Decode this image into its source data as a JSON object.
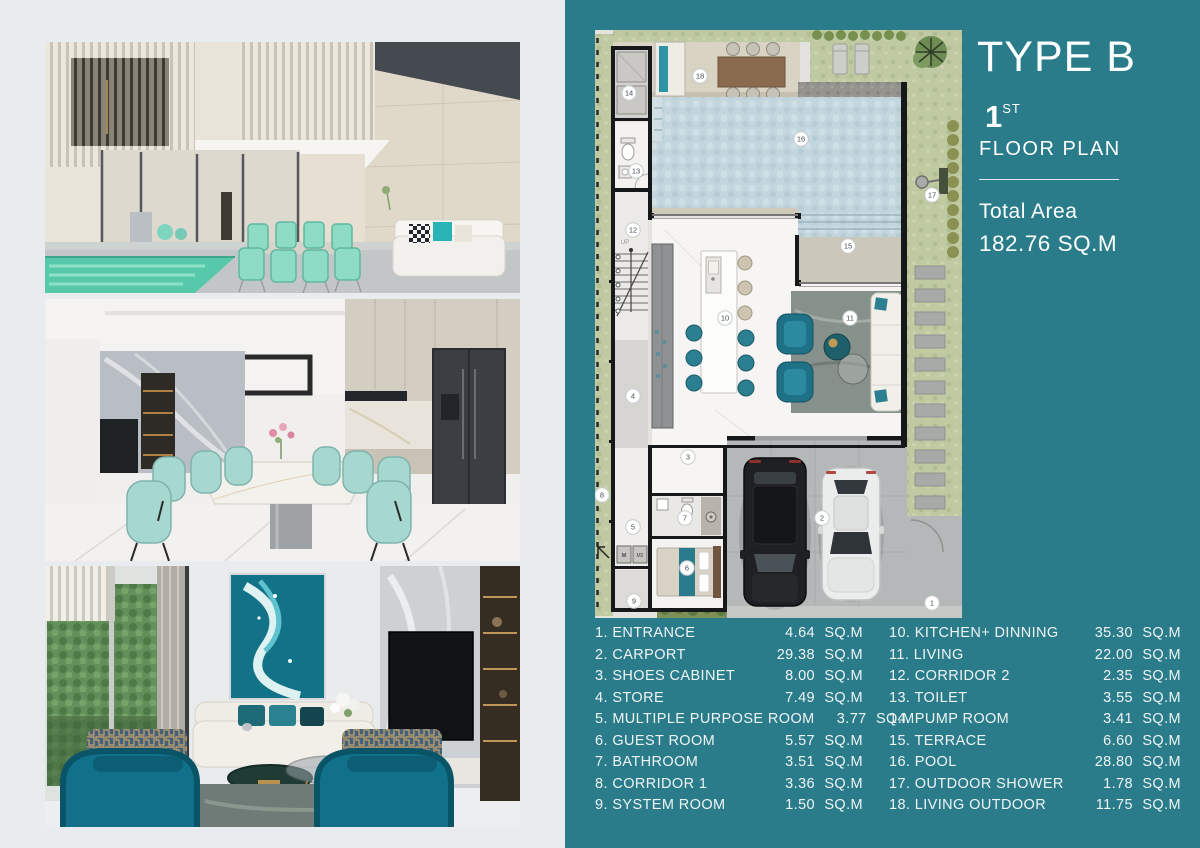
{
  "header": {
    "title": "TYPE B",
    "floor_number": "1",
    "floor_ordinal": "ST",
    "floor_label": "FLOOR PLAN",
    "total_area_label": "Total Area",
    "total_area_value": "182.76 SQ.M"
  },
  "legend": {
    "unit": "SQ.M",
    "left": [
      {
        "id": "1",
        "name": "ENTRANCE",
        "area": "4.64"
      },
      {
        "id": "2",
        "name": "CARPORT",
        "area": "29.38"
      },
      {
        "id": "3",
        "name": "SHOES CABINET",
        "area": "8.00"
      },
      {
        "id": "4",
        "name": "STORE",
        "area": "7.49"
      },
      {
        "id": "5",
        "name": "MULTIPLE PURPOSE ROOM",
        "area": "3.77"
      },
      {
        "id": "6",
        "name": "GUEST ROOM",
        "area": "5.57"
      },
      {
        "id": "7",
        "name": "BATHROOM",
        "area": "3.51"
      },
      {
        "id": "8",
        "name": "CORRIDOR 1",
        "area": "3.36"
      },
      {
        "id": "9",
        "name": "SYSTEM ROOM",
        "area": "1.50"
      }
    ],
    "right": [
      {
        "id": "10",
        "name": "KITCHEN+ DINNING",
        "area": "35.30"
      },
      {
        "id": "11",
        "name": "LIVING",
        "area": "22.00"
      },
      {
        "id": "12",
        "name": "CORRIDOR 2",
        "area": "2.35"
      },
      {
        "id": "13",
        "name": "TOILET",
        "area": "3.55"
      },
      {
        "id": "14",
        "name": "PUMP ROOM",
        "area": "3.41"
      },
      {
        "id": "15",
        "name": "TERRACE",
        "area": "6.60"
      },
      {
        "id": "16",
        "name": "POOL",
        "area": "28.80"
      },
      {
        "id": "17",
        "name": "OUTDOOR SHOWER",
        "area": "1.78"
      },
      {
        "id": "18",
        "name": "LIVING OUTDOOR",
        "area": "11.75"
      }
    ]
  },
  "plan": {
    "up_label": "UP",
    "machines": [
      "M",
      "M2"
    ]
  },
  "colors": {
    "panel_teal": "#2b7c8b",
    "page_light": "#e8ecef",
    "pool_blue": "#c3d6de",
    "grass_green": "#bfcaa3",
    "accent_teal": "#1f7083",
    "text_white": "#fdfefe"
  }
}
